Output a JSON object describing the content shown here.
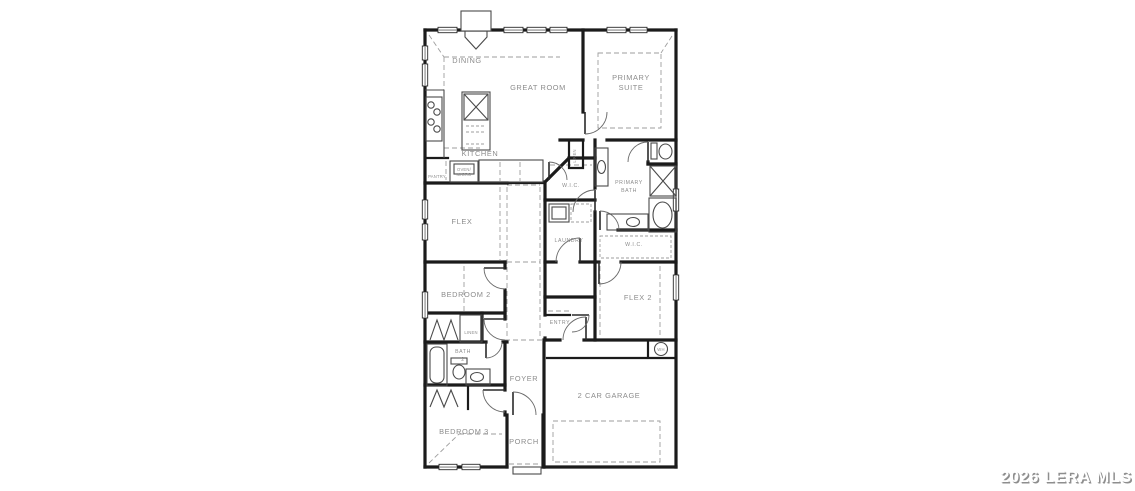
{
  "watermark": {
    "text": "2026 LERA MLS"
  },
  "floorplan": {
    "rooms": {
      "dining": "DINING",
      "great_room": "GREAT ROOM",
      "primary_suite": [
        "PRIMARY",
        "SUITE"
      ],
      "kitchen": "KITCHEN",
      "pantry": "PANTRY",
      "oven_micro": [
        "OVEN/",
        "MICRO"
      ],
      "flex": "FLEX",
      "primary_wic": "W.I.C.",
      "primary_bath": [
        "PRIMARY",
        "BATH"
      ],
      "linen_primary": "LINEN",
      "laundry": "LAUNDRY",
      "secondary_wic": "W.I.C.",
      "bedroom_2": "BEDROOM 2",
      "flex_2": "FLEX 2",
      "entry": "ENTRY",
      "linen_hall": "LINEN",
      "bath_2": [
        "BATH",
        "2"
      ],
      "foyer": "FOYER",
      "garage": "2 CAR GARAGE",
      "bedroom_3": "BEDROOM 3",
      "porch": "PORCH",
      "water_heater": "WH"
    },
    "colors": {
      "wall": "#1b1b1b",
      "label": "#8c8c8c",
      "dashed_line": "#9e9e9e",
      "fixture": "#4a4a4a",
      "window_fill": "#b5b5b5",
      "background": "#ffffff",
      "watermark_face": "#ffffff",
      "watermark_shadow": "#8e8e8e"
    }
  }
}
